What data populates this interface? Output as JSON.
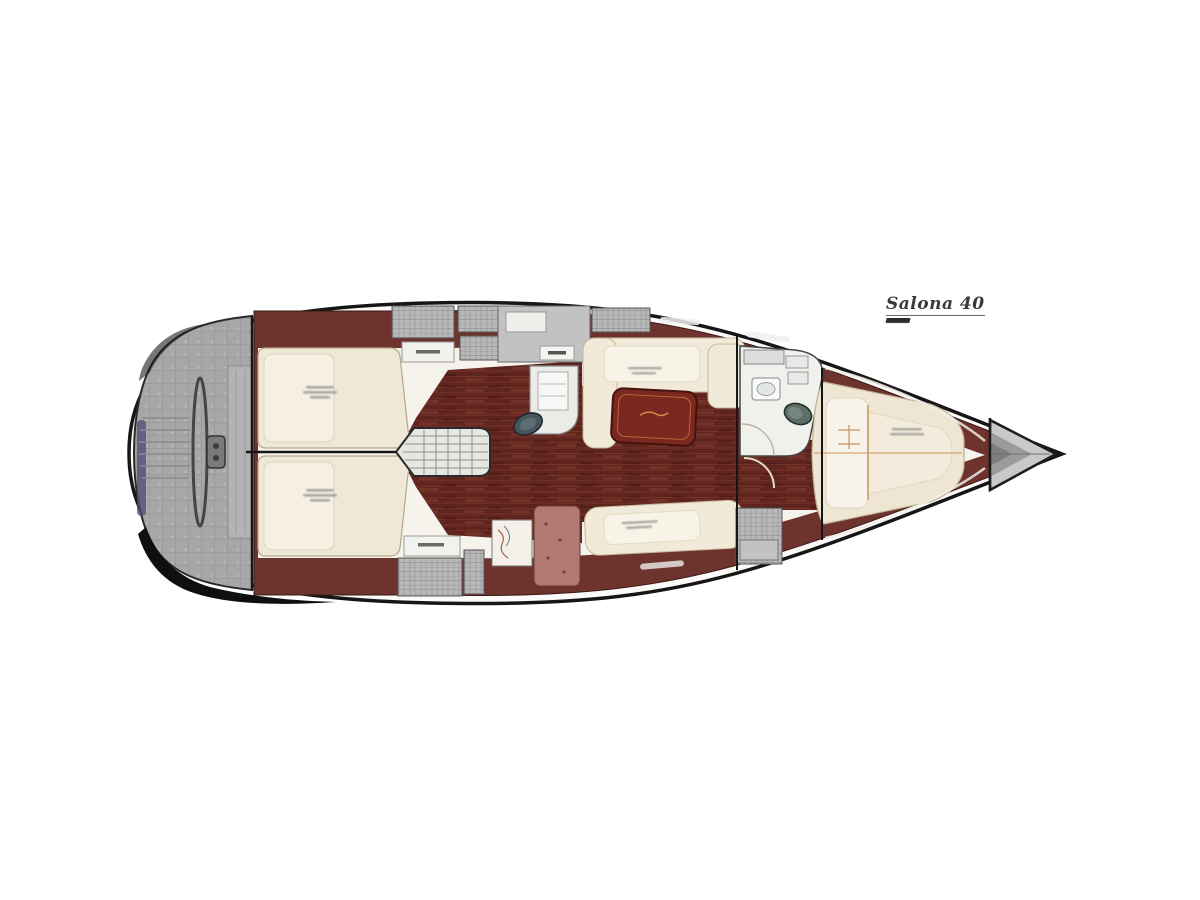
{
  "title": {
    "label": "Salona 40"
  },
  "palette": {
    "background": "#ffffff",
    "hull_outline": "#1c1c1c",
    "deck_band_maroon": "#6d332c",
    "cockpit_gray": "#a7a7a7",
    "interior_white": "#f6f3ec",
    "berth_cream": "#efe8d7",
    "berth_pillow_white": "#f8f3e7",
    "sole_maroon": "#5f241d",
    "sole_plank_light": "#8a4335",
    "table_red": "#7c271f",
    "nav_desk_mauve": "#b07a72",
    "fixture_teal": "#55655f",
    "trim_orange": "#c8935c",
    "accent_navy": "#4a4a78",
    "bow_locker_gray": "#c9c9c9"
  }
}
